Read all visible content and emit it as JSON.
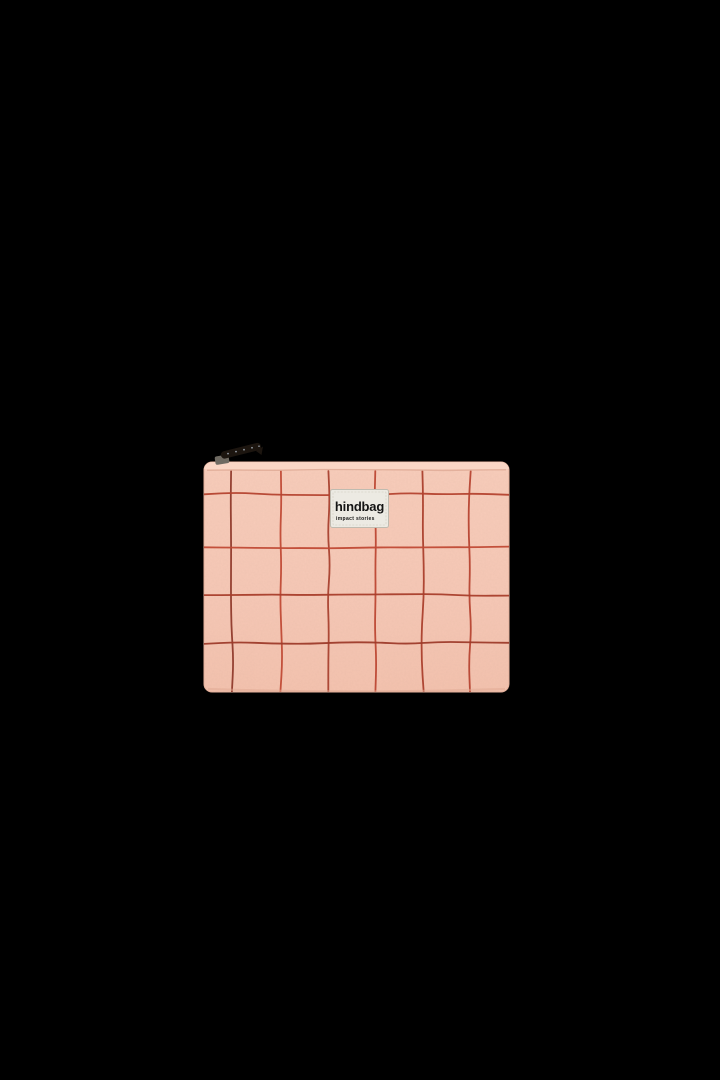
{
  "page": {
    "background_color": "#000000"
  },
  "product": {
    "label": {
      "title": "hindbag",
      "subtitle": "impact stories",
      "background": "#ECEAE3",
      "border": "#BFBBB0",
      "stitch": "#D8D4C9",
      "text_color": "#141414"
    },
    "fabric": {
      "top": "#FAD2C0",
      "upper": "#F8CDBB",
      "mid": "#F6C8B6",
      "bottom": "#F4C3AF",
      "edge": "#E5B19C",
      "seam": "#DFAB96",
      "shadow": "#DFA892",
      "highlight": "#FBD8C8",
      "speckle": "#7A4634"
    },
    "zipper": {
      "strap": "#1C150F",
      "metal": "#6F6A62",
      "glint": "#A8B2BD"
    },
    "grid_pattern": {
      "pouch": {
        "x": 204,
        "y": 462,
        "width": 305,
        "height": 230,
        "corner_radius": 8
      },
      "seam": {
        "y": 470,
        "color": "#DFAB96"
      },
      "vertical_lines": [
        {
          "x": 232,
          "color": "#8F3A2B"
        },
        {
          "x": 281,
          "color": "#C04A35"
        },
        {
          "x": 329,
          "color": "#A8412F"
        },
        {
          "x": 376,
          "color": "#BC4733"
        },
        {
          "x": 423,
          "color": "#AA3F2C"
        },
        {
          "x": 470,
          "color": "#B64531"
        }
      ],
      "horizontal_lines": [
        {
          "y": 494,
          "color": "#B4432F"
        },
        {
          "y": 547,
          "color": "#C04A35"
        },
        {
          "y": 595,
          "color": "#A83E2B"
        },
        {
          "y": 643,
          "color": "#9D3B2A"
        }
      ],
      "line_width": 1.8,
      "wave_amplitude": 3
    }
  }
}
